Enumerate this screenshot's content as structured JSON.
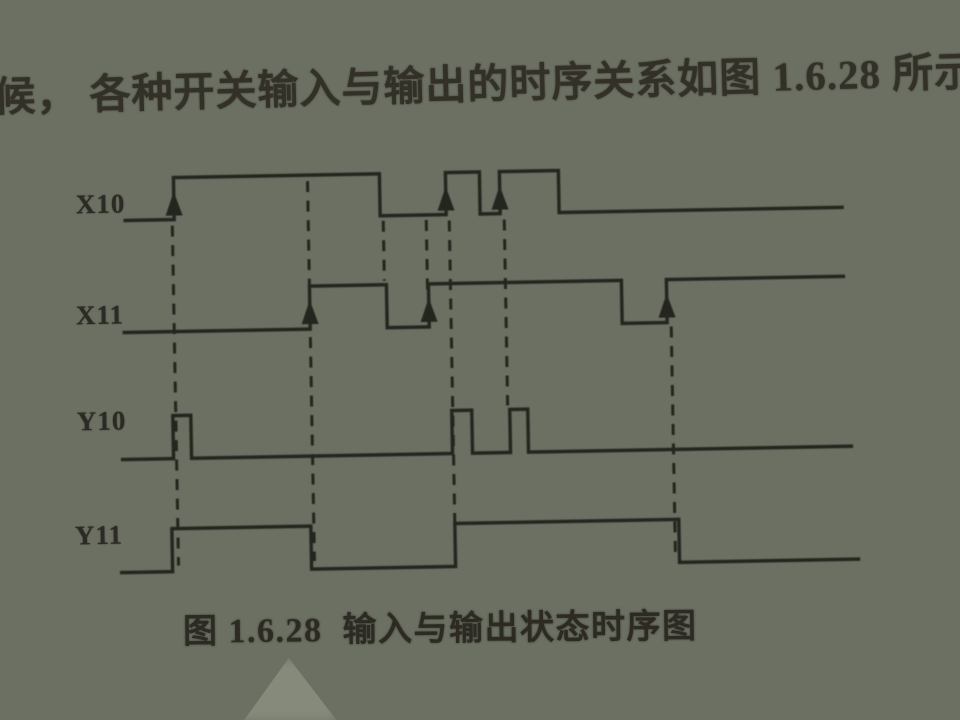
{
  "page": {
    "intro_text": "候， 各种开关输入与输出的时序关系如图 1.6.28 所示。",
    "caption": "图 1.6.28  输入与输出状态时序图",
    "text_color": "#2e2c25",
    "paper_color": "#6b7063"
  },
  "diagram": {
    "type": "timing-diagram",
    "line_color": "#24251e",
    "signals": [
      {
        "label": "X10",
        "high_y": 172,
        "low_y": 214,
        "x_start": 128,
        "x_end": 845,
        "initial": "low",
        "transitions": [
          177,
          383,
          449,
          483,
          503,
          562
        ]
      },
      {
        "label": "X11",
        "high_y": 283,
        "low_y": 326,
        "x_start": 125,
        "x_end": 845,
        "initial": "low",
        "transitions": [
          311,
          388,
          430,
          623,
          668
        ]
      },
      {
        "label": "Y10",
        "high_y": 410,
        "low_y": 453,
        "x_start": 121,
        "x_end": 850,
        "initial": "low",
        "transitions": [
          172,
          190,
          451,
          471,
          509,
          527
        ]
      },
      {
        "label": "Y11",
        "high_y": 523,
        "low_y": 566,
        "x_start": 118,
        "x_end": 855,
        "initial": "low",
        "transitions": [
          169,
          308,
          452,
          676
        ]
      }
    ],
    "arrows": [
      {
        "x": 177,
        "signal": 0
      },
      {
        "x": 449,
        "signal": 0
      },
      {
        "x": 503,
        "signal": 0
      },
      {
        "x": 311,
        "signal": 1
      },
      {
        "x": 430,
        "signal": 1
      },
      {
        "x": 668,
        "signal": 1
      }
    ],
    "dashed_lines": [
      {
        "x": 175,
        "y1": 220,
        "y2": 560
      },
      {
        "x": 311,
        "y1": 178,
        "y2": 558
      },
      {
        "x": 386,
        "y1": 219,
        "y2": 279
      },
      {
        "x": 429,
        "y1": 219,
        "y2": 294
      },
      {
        "x": 452,
        "y1": 220,
        "y2": 560
      },
      {
        "x": 507,
        "y1": 220,
        "y2": 406
      },
      {
        "x": 672,
        "y1": 330,
        "y2": 560
      }
    ]
  }
}
